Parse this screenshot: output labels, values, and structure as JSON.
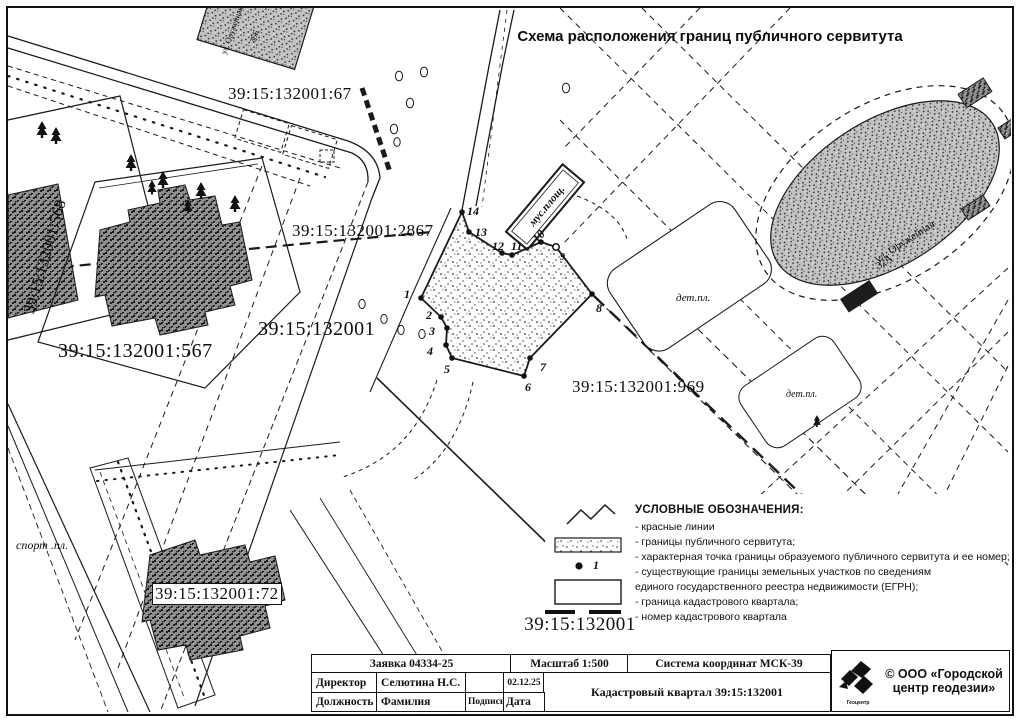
{
  "title": "Схема расположения границ публичного сервитута",
  "labels": {
    "p67": "39:15:132001:67",
    "p2867": "39:15:132001:2867",
    "p568": "39:15:132001:568",
    "p567": "39:15:132001:567",
    "quarter": "39:15:132001",
    "p969": "39:15:132001:969",
    "p72": "39:15:132001:72",
    "det_pl": "дет.пл.",
    "det_pl2": "дет.пл.",
    "sport_pl": "спорт .пл.",
    "mus": "мус.площ.",
    "street": "ул. Оружейная",
    "num32a": "32А",
    "street_top": "ул. Оружейная",
    "num36b": "36Б"
  },
  "points": [
    "1",
    "2",
    "3",
    "4",
    "5",
    "6",
    "7",
    "8",
    "9",
    "10",
    "11",
    "12",
    "13",
    "14"
  ],
  "legend": {
    "title": "УСЛОВНЫЕ ОБОЗНАЧЕНИЯ:",
    "items": [
      "- красные линии",
      "-  границы публичного сервитута;",
      "- характерная точка границы образуемого публичного сервитута и ее номер;",
      "- существующие  границы земельных участков по сведениям",
      "   единого государственного реестра недвижимости (ЕГРН);",
      "- граница кадастрового квартала;",
      "- номер кадастрового квартала"
    ],
    "point_number": "1",
    "quarter_number": "39:15:132001"
  },
  "table": {
    "request": "Заявка 04334-25",
    "scale": "Масштаб 1:500",
    "coord_system": "Система координат МСК-39",
    "director_title": "Директор",
    "director_name": "Селютина Н.С.",
    "date_value": "02.12.25",
    "position_label": "Должность",
    "surname_label": "Фамилия",
    "signature_label": "Подпись",
    "date_label": "Дата",
    "quarter_label": "Кадастровый квартал  39:15:132001"
  },
  "logo": {
    "company": "© ООО «Городской центр геодезии»",
    "mark_caption": "Геоцентр"
  }
}
